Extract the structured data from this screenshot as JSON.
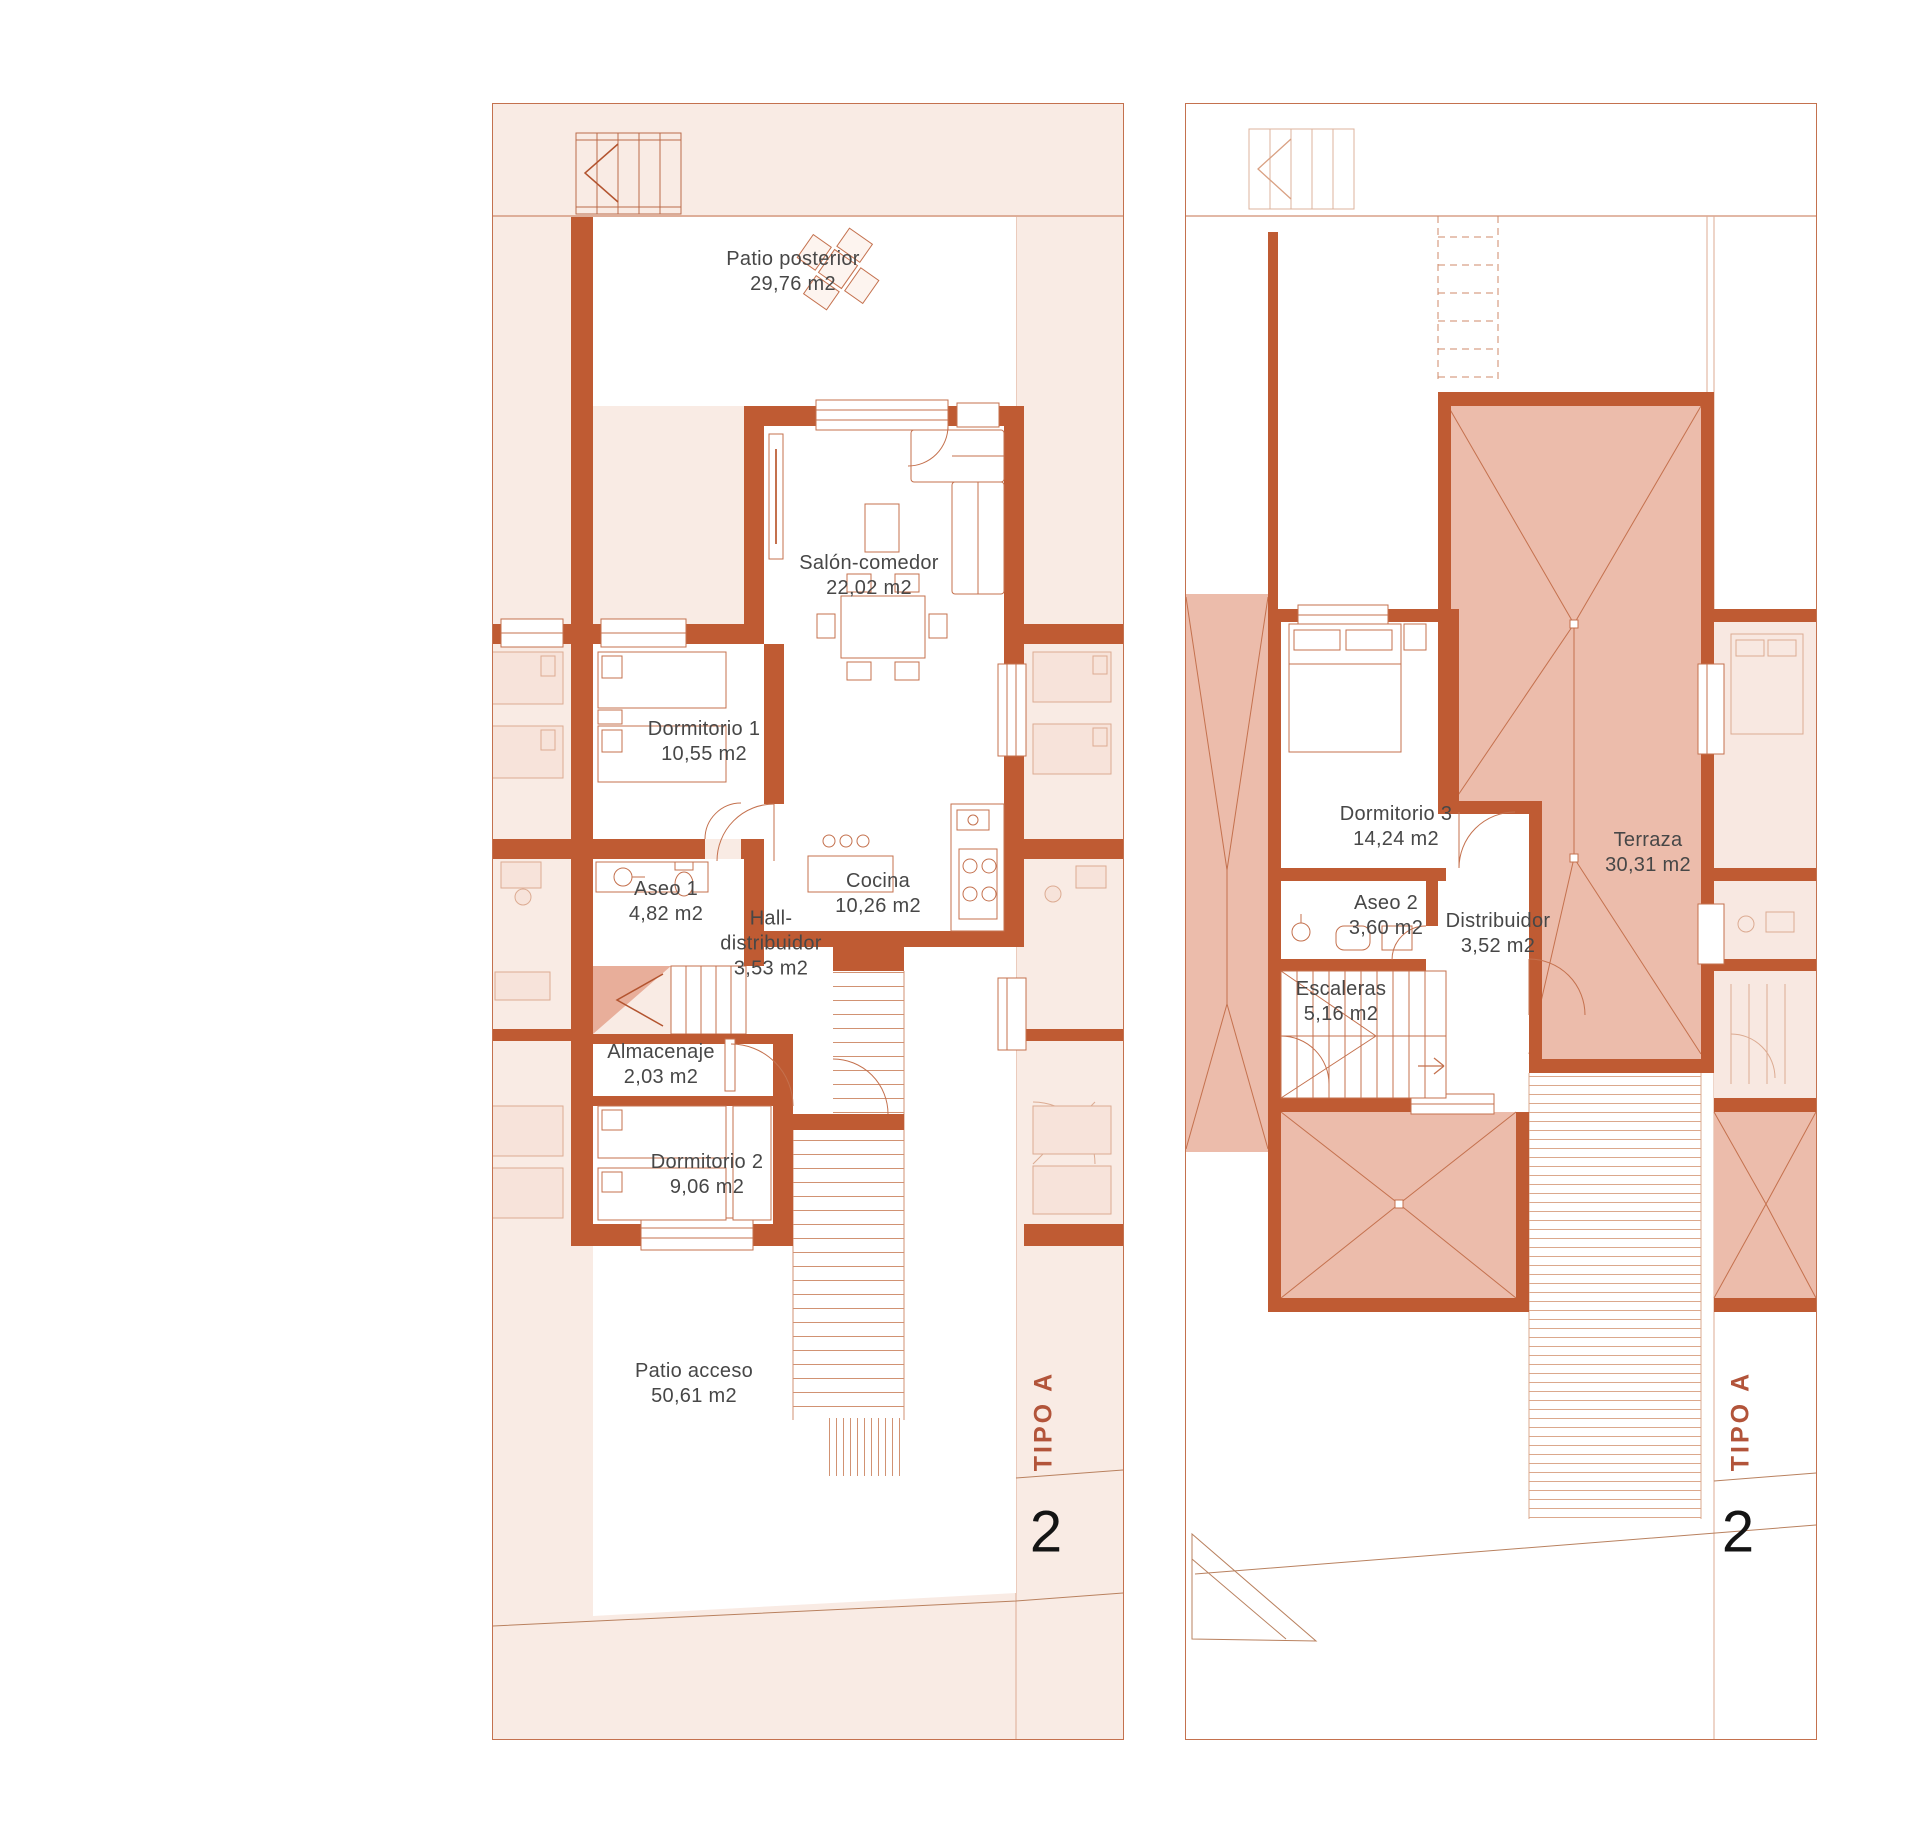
{
  "palette": {
    "wall": "#bf5b33",
    "plan_tint": "#f9ebe4",
    "roof_tint": "#ecbcab",
    "line": "#c4714e",
    "label_text": "#474747",
    "type_accent": "#b2543a",
    "unit_number_color": "#141414"
  },
  "plans": [
    {
      "id": "ground-floor",
      "type_label": "TIPO A",
      "unit_number": "2",
      "rooms": [
        {
          "name": "Patio posterior",
          "area": "29,76 m2"
        },
        {
          "name": "Salón-comedor",
          "area": "22,02 m2"
        },
        {
          "name": "Dormitorio 1",
          "area": "10,55 m2"
        },
        {
          "name": "Aseo 1",
          "area": "4,82 m2"
        },
        {
          "name": "Hall-distribuidor",
          "area": "3,53 m2"
        },
        {
          "name": "Cocina",
          "area": "10,26 m2"
        },
        {
          "name": "Almacenaje",
          "area": "2,03 m2"
        },
        {
          "name": "Dormitorio 2",
          "area": "9,06 m2"
        },
        {
          "name": "Patio acceso",
          "area": "50,61 m2"
        }
      ]
    },
    {
      "id": "first-floor",
      "type_label": "TIPO A",
      "unit_number": "2",
      "rooms": [
        {
          "name": "Dormitorio 3",
          "area": "14,24 m2"
        },
        {
          "name": "Aseo 2",
          "area": "3,60 m2"
        },
        {
          "name": "Distribuidor",
          "area": "3,52 m2"
        },
        {
          "name": "Escaleras",
          "area": "5,16 m2"
        },
        {
          "name": "Terraza",
          "area": "30,31 m2"
        }
      ]
    }
  ]
}
